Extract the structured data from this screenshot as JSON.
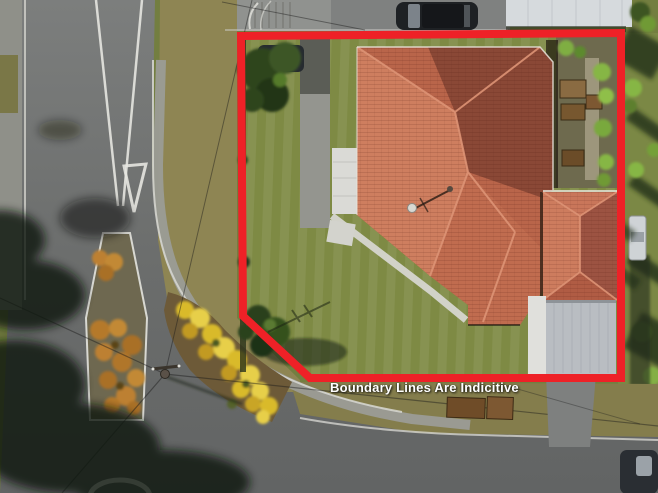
{
  "overlay": {
    "disclaimer_text": "Boundary Lines Are Indicitive",
    "text_color": "#ffffff",
    "boundary_color": "#ee2127",
    "boundary_width": "8"
  },
  "palette": {
    "ground_base": "#737e40",
    "lawn": "#7e8a44",
    "verge": "#8e8553",
    "road": "#6e706f",
    "footpath": "#9b9c96",
    "roof_base": "#b9654a",
    "roof_bright": "#ce7e5f",
    "roof_shaded": "#8a4836",
    "carport": "#b9bdc2",
    "white_building": "#d6dadd",
    "yellow_flowers": "#dcbf2c",
    "orange_flowers": "#bd8030",
    "tree_dark": "#2c3d1c"
  }
}
